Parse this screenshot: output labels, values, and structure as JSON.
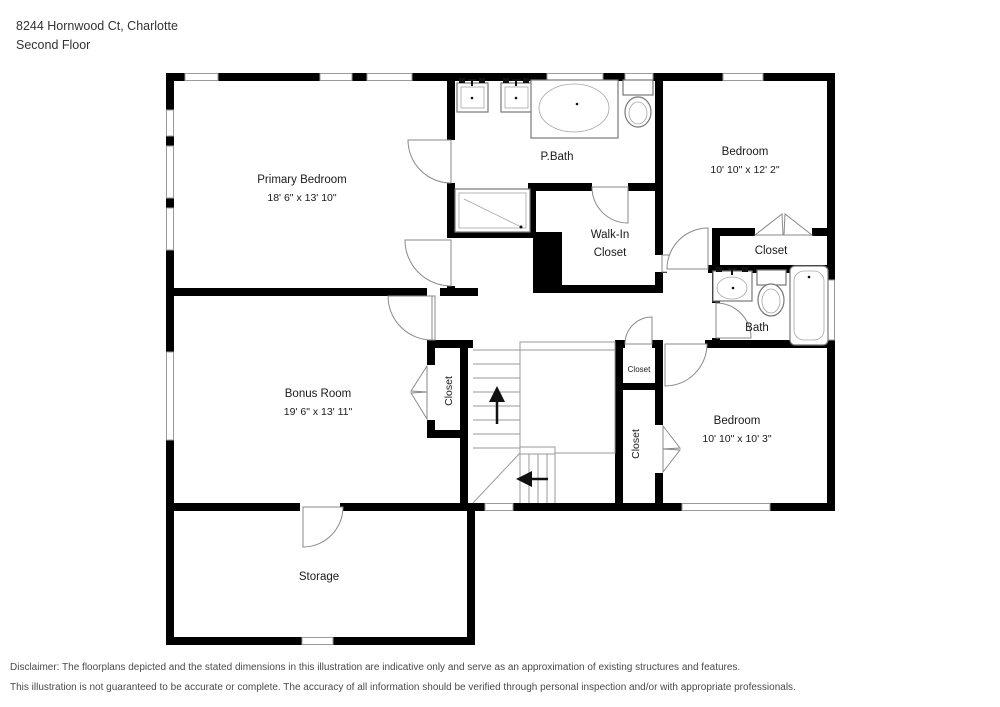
{
  "header": {
    "address": "8244 Hornwood Ct, Charlotte",
    "floor": "Second Floor"
  },
  "rooms": {
    "primary_bedroom": {
      "name": "Primary Bedroom",
      "dims": "18' 6\" x 13' 10\""
    },
    "p_bath": {
      "name": "P.Bath"
    },
    "bedroom_top_right": {
      "name": "Bedroom",
      "dims": "10' 10\" x 12' 2\""
    },
    "walk_in_closet": {
      "line1": "Walk-In",
      "line2": "Closet"
    },
    "closet_top_right": {
      "name": "Closet"
    },
    "bath": {
      "name": "Bath"
    },
    "bonus_room": {
      "name": "Bonus Room",
      "dims": "19' 6\" x 13' 11\""
    },
    "bonus_closet": {
      "name": "Closet"
    },
    "hall_closet_small": {
      "name": "Closet"
    },
    "hall_closet_tall": {
      "name": "Closet"
    },
    "bedroom_bottom_right": {
      "name": "Bedroom",
      "dims": "10' 10\" x 10' 3\""
    },
    "storage": {
      "name": "Storage"
    }
  },
  "disclaimer": {
    "line1": "Disclaimer: The floorplans depicted and the stated dimensions in this illustration are indicative only and serve as an approximation of existing structures and features.",
    "line2": "This illustration is not guaranteed to be accurate or complete. The accuracy of all information should be verified through personal inspection and/or with appropriate professionals."
  },
  "colors": {
    "wall": "#000000",
    "text": "#1a1a1a",
    "line": "#9a9a9a",
    "fixture": "#777777",
    "header": "#333333",
    "disclaimer": "#4a4a4a"
  }
}
